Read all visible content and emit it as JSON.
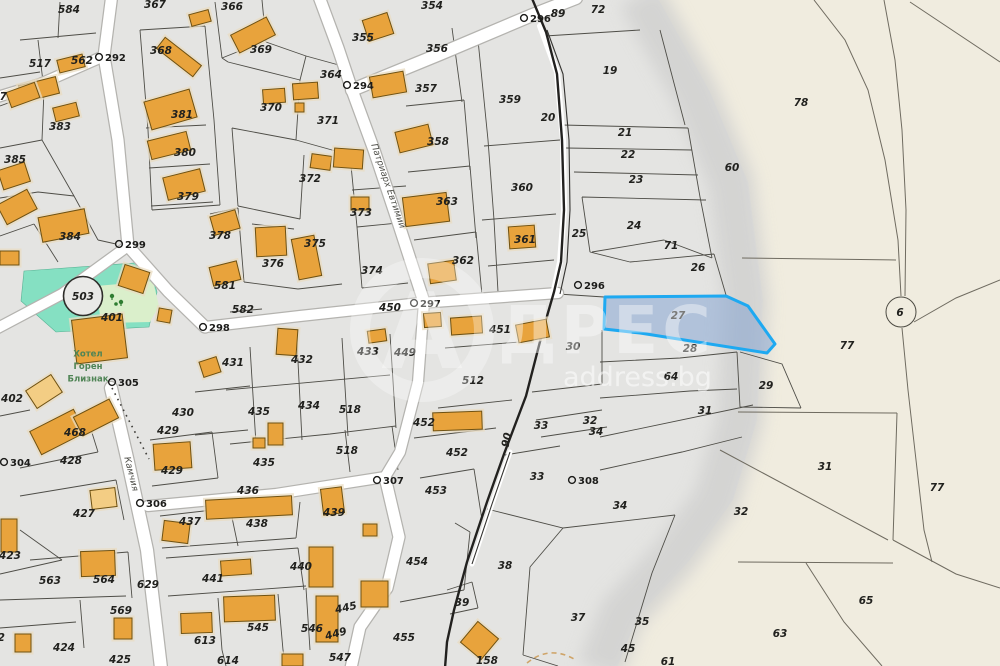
{
  "brand": {
    "watermark_letter": "А",
    "watermark_name": "ДРЕС",
    "watermark_domain": "address.bg"
  },
  "selected_parcel": {
    "number": "27",
    "outline": "#1ea9f1",
    "fill": "rgba(122,156,208,0.48)"
  },
  "landmarks": {
    "circle_503": "503",
    "circle_6": "6"
  },
  "poi": {
    "name_lines": [
      "Хотел",
      "Горен",
      "Близнак"
    ],
    "color": "#4f8455"
  },
  "streets": [
    {
      "name": "Патриарх Евтимий",
      "x": 388,
      "y": 186,
      "rot": 71
    },
    {
      "name": "Камчия",
      "x": 131,
      "y": 474,
      "rot": 76
    }
  ],
  "geodetic_markers": [
    [
      "292",
      99,
      57
    ],
    [
      "294",
      347,
      85
    ],
    [
      "296",
      524,
      18
    ],
    [
      "296",
      578,
      285
    ],
    [
      "297",
      414,
      303
    ],
    [
      "298",
      203,
      327
    ],
    [
      "299",
      119,
      244
    ],
    [
      "304",
      4,
      462
    ],
    [
      "305",
      112,
      382
    ],
    [
      "306",
      140,
      503
    ],
    [
      "307",
      377,
      480
    ],
    [
      "308",
      572,
      480
    ]
  ],
  "parcel_labels": [
    [
      "584",
      69,
      10
    ],
    [
      "367",
      155,
      5
    ],
    [
      "366",
      232,
      7
    ],
    [
      "369",
      261,
      50
    ],
    [
      "355",
      363,
      38
    ],
    [
      "354",
      432,
      6
    ],
    [
      "356",
      437,
      49
    ],
    [
      "364",
      331,
      75
    ],
    [
      "357",
      426,
      89
    ],
    [
      "358",
      438,
      142
    ],
    [
      "359",
      510,
      100
    ],
    [
      "19",
      610,
      71
    ],
    [
      "72",
      598,
      10
    ],
    [
      "89",
      558,
      14
    ],
    [
      "78",
      801,
      103
    ],
    [
      "20",
      548,
      118
    ],
    [
      "21",
      625,
      133
    ],
    [
      "22",
      628,
      155
    ],
    [
      "23",
      636,
      180
    ],
    [
      "60",
      732,
      168
    ],
    [
      "24",
      634,
      226
    ],
    [
      "25",
      579,
      234
    ],
    [
      "71",
      671,
      246
    ],
    [
      "26",
      698,
      268
    ],
    [
      "517",
      40,
      64
    ],
    [
      "562",
      82,
      61
    ],
    [
      "368",
      161,
      51
    ],
    [
      "383",
      60,
      127
    ],
    [
      "381",
      182,
      115
    ],
    [
      "380",
      185,
      153
    ],
    [
      "385",
      15,
      160
    ],
    [
      "379",
      188,
      197
    ],
    [
      "387",
      -4,
      97
    ],
    [
      "384",
      70,
      237
    ],
    [
      "370",
      271,
      108
    ],
    [
      "371",
      328,
      121
    ],
    [
      "372",
      310,
      179
    ],
    [
      "373",
      361,
      213
    ],
    [
      "374",
      372,
      271
    ],
    [
      "375",
      315,
      244
    ],
    [
      "376",
      273,
      264
    ],
    [
      "378",
      220,
      236
    ],
    [
      "363",
      447,
      202
    ],
    [
      "362",
      463,
      261
    ],
    [
      "361",
      525,
      240
    ],
    [
      "360",
      522,
      188
    ],
    [
      "581",
      225,
      286
    ],
    [
      "582",
      243,
      310
    ],
    [
      "450",
      390,
      308
    ],
    [
      "451",
      500,
      330
    ],
    [
      "449",
      405,
      353
    ],
    [
      "433",
      368,
      352
    ],
    [
      "432",
      302,
      360
    ],
    [
      "431",
      233,
      363
    ],
    [
      "512",
      473,
      381
    ],
    [
      "401",
      112,
      318
    ],
    [
      "402",
      12,
      399
    ],
    [
      "430",
      183,
      413
    ],
    [
      "429",
      168,
      431
    ],
    [
      "429",
      172,
      471
    ],
    [
      "435",
      259,
      412
    ],
    [
      "434",
      309,
      406
    ],
    [
      "518",
      350,
      410
    ],
    [
      "518",
      347,
      451
    ],
    [
      "435",
      264,
      463
    ],
    [
      "436",
      248,
      491
    ],
    [
      "468",
      75,
      433
    ],
    [
      "428",
      71,
      461
    ],
    [
      "427",
      84,
      514
    ],
    [
      "423",
      10,
      556
    ],
    [
      "437",
      190,
      522
    ],
    [
      "438",
      257,
      524
    ],
    [
      "439",
      334,
      513
    ],
    [
      "441",
      213,
      579
    ],
    [
      "440",
      301,
      567
    ],
    [
      "563",
      50,
      581
    ],
    [
      "564",
      104,
      580
    ],
    [
      "569",
      121,
      611
    ],
    [
      "629",
      148,
      585
    ],
    [
      "613",
      205,
      641
    ],
    [
      "614",
      228,
      661
    ],
    [
      "545",
      258,
      628
    ],
    [
      "546",
      312,
      629
    ],
    [
      "547",
      340,
      658
    ],
    [
      "424",
      64,
      648
    ],
    [
      "425",
      120,
      660
    ],
    [
      "402",
      -6,
      638
    ],
    [
      "452",
      424,
      423
    ],
    [
      "452",
      457,
      453
    ],
    [
      "453",
      436,
      491
    ],
    [
      "454",
      417,
      562
    ],
    [
      "455",
      404,
      638
    ],
    [
      "445",
      346,
      608,
      -12
    ],
    [
      "449",
      336,
      634,
      -15
    ],
    [
      "90",
      507,
      440,
      -78
    ],
    [
      "30",
      573,
      347
    ],
    [
      "27",
      678,
      316
    ],
    [
      "28",
      690,
      349
    ],
    [
      "64",
      671,
      377
    ],
    [
      "29",
      766,
      386
    ],
    [
      "31",
      705,
      411
    ],
    [
      "32",
      590,
      421
    ],
    [
      "34",
      596,
      432
    ],
    [
      "33",
      541,
      426
    ],
    [
      "33",
      537,
      477
    ],
    [
      "34",
      620,
      506
    ],
    [
      "38",
      505,
      566
    ],
    [
      "39",
      462,
      603
    ],
    [
      "37",
      578,
      618
    ],
    [
      "35",
      642,
      622
    ],
    [
      "45",
      628,
      649
    ],
    [
      "158",
      487,
      661
    ],
    [
      "61",
      668,
      662
    ],
    [
      "31",
      825,
      467
    ],
    [
      "32",
      741,
      512
    ],
    [
      "77",
      847,
      346
    ],
    [
      "77",
      937,
      488
    ],
    [
      "65",
      866,
      601
    ],
    [
      "63",
      780,
      634
    ]
  ],
  "buildings": [
    [
      156,
      50,
      46,
      14,
      38,
      0
    ],
    [
      58,
      57,
      26,
      13,
      -14,
      0
    ],
    [
      190,
      12,
      20,
      12,
      -15,
      0
    ],
    [
      233,
      25,
      40,
      20,
      -27,
      0
    ],
    [
      365,
      16,
      26,
      22,
      -18,
      0
    ],
    [
      371,
      74,
      34,
      21,
      -10,
      0
    ],
    [
      397,
      128,
      34,
      21,
      -14,
      0
    ],
    [
      404,
      195,
      44,
      29,
      -7,
      0
    ],
    [
      429,
      262,
      26,
      20,
      -8,
      0
    ],
    [
      509,
      226,
      26,
      22,
      -4,
      0
    ],
    [
      147,
      95,
      47,
      29,
      -16,
      0
    ],
    [
      149,
      136,
      40,
      19,
      -14,
      0
    ],
    [
      165,
      173,
      38,
      23,
      -14,
      0
    ],
    [
      20,
      81,
      38,
      17,
      -14,
      0
    ],
    [
      54,
      105,
      24,
      14,
      -14,
      0
    ],
    [
      8,
      87,
      30,
      16,
      -20,
      0
    ],
    [
      0,
      166,
      28,
      20,
      -18,
      0
    ],
    [
      0,
      196,
      34,
      22,
      -28,
      0
    ],
    [
      40,
      213,
      47,
      25,
      -11,
      0
    ],
    [
      263,
      89,
      22,
      14,
      -4,
      0
    ],
    [
      295,
      103,
      9,
      9,
      0,
      0
    ],
    [
      293,
      83,
      25,
      16,
      -4,
      0
    ],
    [
      311,
      155,
      20,
      14,
      8,
      0
    ],
    [
      334,
      149,
      29,
      19,
      4,
      0
    ],
    [
      351,
      197,
      18,
      13,
      0,
      0
    ],
    [
      295,
      237,
      23,
      41,
      -11,
      0
    ],
    [
      256,
      227,
      30,
      29,
      -3,
      0
    ],
    [
      212,
      213,
      26,
      19,
      -16,
      0
    ],
    [
      211,
      264,
      28,
      19,
      -14,
      0
    ],
    [
      74,
      317,
      51,
      44,
      -7,
      0
    ],
    [
      121,
      268,
      26,
      22,
      18,
      0
    ],
    [
      158,
      309,
      13,
      13,
      10,
      0
    ],
    [
      0,
      251,
      19,
      14,
      0,
      0
    ],
    [
      29,
      381,
      30,
      21,
      -33,
      1
    ],
    [
      33,
      419,
      49,
      26,
      -27,
      0
    ],
    [
      76,
      407,
      40,
      21,
      -27,
      0
    ],
    [
      154,
      443,
      37,
      26,
      -4,
      0
    ],
    [
      163,
      522,
      26,
      20,
      7,
      0
    ],
    [
      91,
      489,
      25,
      19,
      -7,
      1
    ],
    [
      1,
      519,
      16,
      33,
      0,
      0
    ],
    [
      81,
      551,
      34,
      25,
      -2,
      0
    ],
    [
      114,
      618,
      18,
      21,
      0,
      0
    ],
    [
      15,
      634,
      16,
      18,
      0,
      0
    ],
    [
      181,
      613,
      31,
      20,
      -2,
      0
    ],
    [
      224,
      596,
      51,
      25,
      -2,
      0
    ],
    [
      206,
      498,
      86,
      19,
      -3,
      0
    ],
    [
      322,
      488,
      21,
      26,
      -7,
      0
    ],
    [
      309,
      547,
      24,
      40,
      0,
      0
    ],
    [
      221,
      560,
      30,
      15,
      -4,
      0
    ],
    [
      361,
      581,
      27,
      26,
      0,
      0
    ],
    [
      466,
      627,
      27,
      27,
      40,
      0
    ],
    [
      282,
      654,
      21,
      12,
      0,
      0
    ],
    [
      316,
      596,
      22,
      46,
      0,
      0
    ],
    [
      433,
      412,
      49,
      18,
      -2,
      0
    ],
    [
      451,
      317,
      31,
      17,
      -4,
      0
    ],
    [
      424,
      313,
      17,
      14,
      -4,
      0
    ],
    [
      368,
      330,
      18,
      12,
      -8,
      0
    ],
    [
      517,
      322,
      31,
      18,
      -11,
      0
    ],
    [
      201,
      359,
      18,
      16,
      -18,
      0
    ],
    [
      277,
      329,
      20,
      26,
      4,
      0
    ],
    [
      268,
      423,
      15,
      22,
      0,
      0
    ],
    [
      253,
      438,
      12,
      10,
      0,
      0
    ],
    [
      363,
      524,
      14,
      12,
      0,
      0
    ]
  ],
  "colors": {
    "urban": "#e4e4e2",
    "rural": "#f0ecdf",
    "wash": "#d2d2d0",
    "building": "#e8a33c",
    "building_light": "#f3cd84",
    "building_edge": "#6e5112",
    "road": "#ffffff",
    "road_edge": "#b4b3af",
    "park": "#85e0c2",
    "park_light": "#daefcb",
    "boundary": "#4e4d47",
    "boundary_rural": "#6f6b60",
    "heavy_line": "#22211f"
  }
}
